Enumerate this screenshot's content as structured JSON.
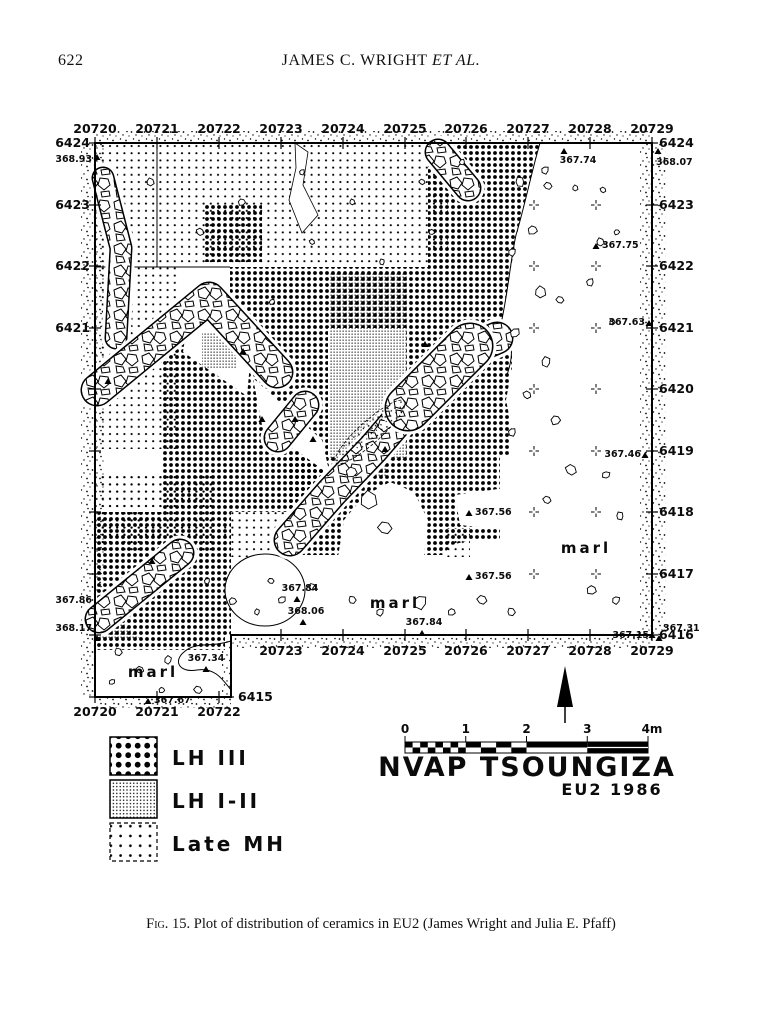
{
  "page": {
    "number": "622",
    "header": "JAMES C. WRIGHT ",
    "header_em": "ET AL.",
    "caption_label": "Fig. 15.",
    "caption_text": "  Plot of distribution of ceramics in EU2 (James Wright and Julia E. Pfaff)"
  },
  "map": {
    "title": "NVAP TSOUNGIZA",
    "subtitle": "EU2 1986",
    "top_axis": [
      "20720",
      "20721",
      "20722",
      "20723",
      "20724",
      "20725",
      "20726",
      "20727",
      "20728",
      "20729"
    ],
    "bottom_axis": [
      "20723",
      "20724",
      "20725",
      "20726",
      "20727",
      "20728",
      "20729"
    ],
    "extension_axis": [
      "20720",
      "20721",
      "20722"
    ],
    "left_axis": [
      "6424",
      "6423",
      "6422",
      "6421"
    ],
    "left_bottom_label": "6415",
    "right_axis": [
      "6424",
      "6423",
      "6422",
      "6421",
      "6420",
      "6419",
      "6418",
      "6417",
      "6416"
    ],
    "marl_labels": [
      "marl",
      "marl",
      "marl"
    ],
    "scale_labels": [
      "0",
      "1",
      "2",
      "3",
      "4m"
    ],
    "legend": [
      {
        "label": "LH III",
        "pattern": "dense-dots"
      },
      {
        "label": "LH I-II",
        "pattern": "fine-stipple"
      },
      {
        "label": "Late MH",
        "pattern": "sparse-dots"
      }
    ],
    "elevations": [
      {
        "v": "368.93",
        "x": 92,
        "y": 162,
        "a": "end",
        "t": [
          97,
          158
        ]
      },
      {
        "v": "367.74",
        "x": 578,
        "y": 163,
        "a": "middle",
        "t": [
          564,
          152
        ]
      },
      {
        "v": "368.07",
        "x": 656,
        "y": 165,
        "a": "start",
        "t": [
          658,
          152
        ]
      },
      {
        "v": "367.75",
        "x": 602,
        "y": 248,
        "a": "start",
        "t": [
          596,
          247
        ]
      },
      {
        "v": "367.63",
        "x": 645,
        "y": 325,
        "a": "end",
        "t": [
          649,
          324
        ]
      },
      {
        "v": "367.46",
        "x": 641,
        "y": 457,
        "a": "end",
        "t": [
          645,
          456
        ]
      },
      {
        "v": "367.56",
        "x": 475,
        "y": 515,
        "a": "start",
        "t": [
          469,
          514
        ]
      },
      {
        "v": "367.56",
        "x": 475,
        "y": 579,
        "a": "start",
        "t": [
          469,
          578
        ]
      },
      {
        "v": "367.15",
        "x": 649,
        "y": 638,
        "a": "end",
        "t": [
          652,
          636
        ]
      },
      {
        "v": "367.31",
        "x": 663,
        "y": 631,
        "a": "start",
        "t": [
          659,
          639
        ]
      },
      {
        "v": "367.86",
        "x": 92,
        "y": 603,
        "a": "end",
        "t": null
      },
      {
        "v": "368.17",
        "x": 92,
        "y": 631,
        "a": "end",
        "t": [
          97,
          639
        ]
      },
      {
        "v": "367.34",
        "x": 206,
        "y": 661,
        "a": "middle",
        "t": [
          206,
          670
        ]
      },
      {
        "v": "367.67",
        "x": 154,
        "y": 703,
        "a": "start",
        "t": [
          148,
          702
        ]
      },
      {
        "v": "368.06",
        "x": 306,
        "y": 614,
        "a": "middle",
        "t": [
          303,
          623
        ]
      },
      {
        "v": "367.84",
        "x": 300,
        "y": 591,
        "a": "middle",
        "t": [
          297,
          600
        ]
      },
      {
        "v": "367.84",
        "x": 424,
        "y": 625,
        "a": "middle",
        "t": [
          422,
          634
        ]
      }
    ]
  }
}
